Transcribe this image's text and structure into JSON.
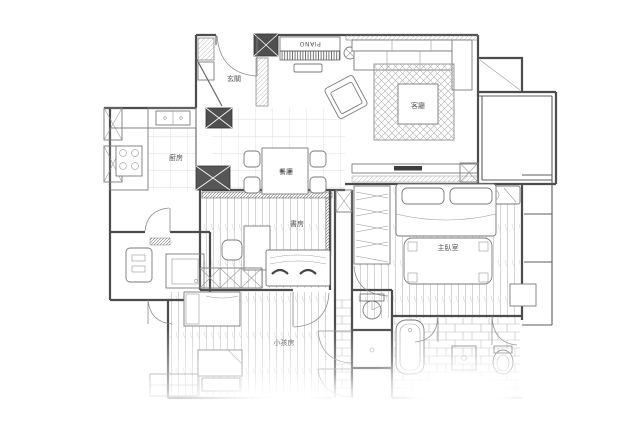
{
  "rooms": {
    "foyer": {
      "label": "玄關"
    },
    "kitchen": {
      "label": "廚房"
    },
    "dining": {
      "label": "餐廳"
    },
    "living": {
      "label": "客廳"
    },
    "study": {
      "label": "書房"
    },
    "kids_room": {
      "label": "小孩房"
    },
    "master_bedroom": {
      "label": "主臥室"
    }
  },
  "annotations": {
    "piano": "PIANO"
  },
  "colors": {
    "background": "#ffffff",
    "wall_line": "#4c4c4c",
    "furniture_line": "#7a7a7a",
    "hatch_line": "#b0b0b0",
    "label_text": "#555555"
  }
}
